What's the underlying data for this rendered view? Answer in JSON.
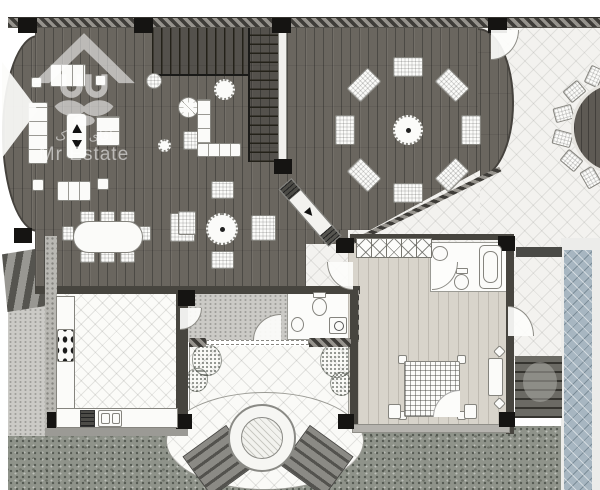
{
  "watermark": {
    "brand_latin": "Mr Estate",
    "brand_persian": "آقای املاک",
    "logo": "house-face-logo"
  },
  "palette": {
    "dark_wood_floor": "#6a665f",
    "light_wood_floor": "#d8d4cb",
    "pool_water": "#a7b6c1",
    "grass": "#8f938a",
    "patio_tile": "#f3f2ef",
    "wall_dark": "#47453f",
    "column_black": "#151412",
    "background": "#ffffff"
  }
}
